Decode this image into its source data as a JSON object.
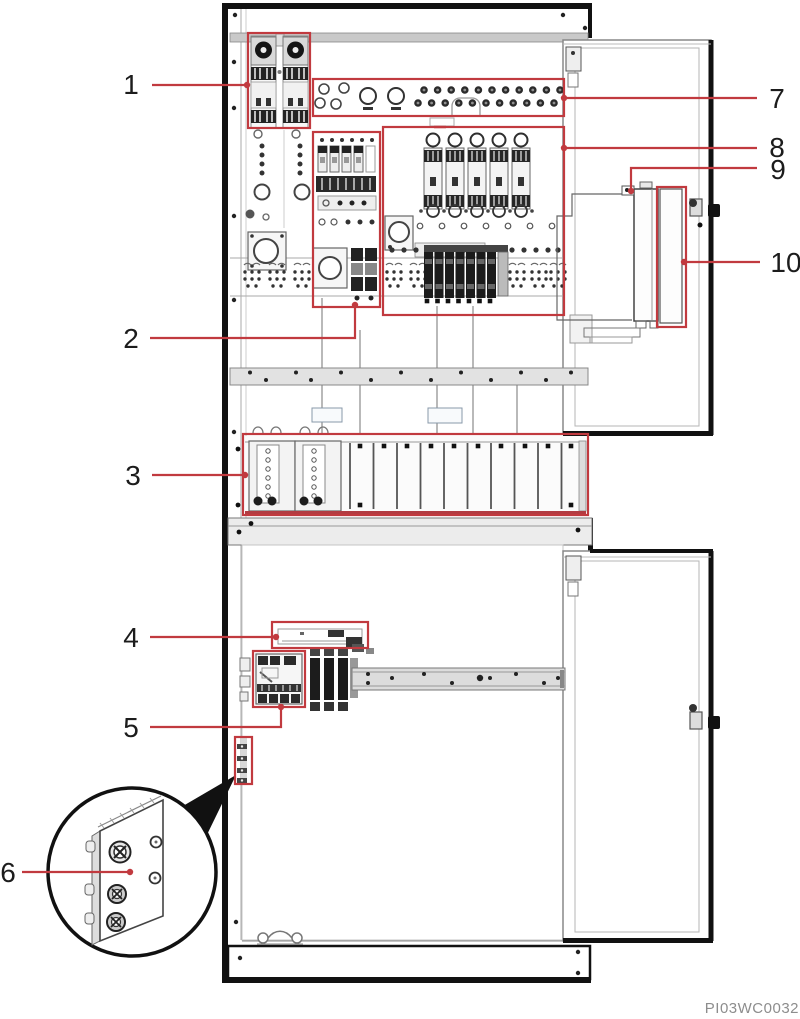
{
  "figure": {
    "image_code": "PI03WC0032",
    "accent_color": "#c13a3f",
    "line_color": "#1a1a1a",
    "callouts": [
      {
        "num": "1"
      },
      {
        "num": "2"
      },
      {
        "num": "3"
      },
      {
        "num": "4"
      },
      {
        "num": "5"
      },
      {
        "num": "6"
      },
      {
        "num": "7"
      },
      {
        "num": "8"
      },
      {
        "num": "9"
      },
      {
        "num": "10"
      }
    ]
  }
}
